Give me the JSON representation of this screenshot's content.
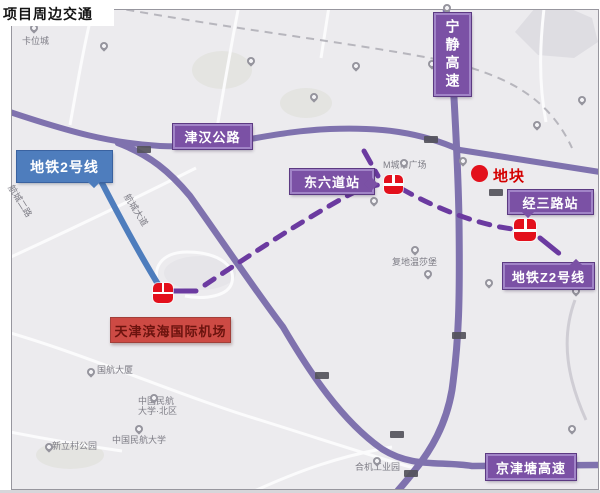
{
  "title": "项目周边交通",
  "colors": {
    "banner_purple": "#7b51a5",
    "banner_purple_light": "#a184c7",
    "banner_purple_dark": "#5c3a82",
    "road_purple": "#7f72ae",
    "dashed_metro_purple": "#6b3aa0",
    "metro_blue": "#4e7dbd",
    "red_banner": "#cd4a44",
    "red_banner_text": "#6b130e",
    "plot_red": "#e3101c",
    "map_background": "#ecebee"
  },
  "callouts": {
    "metro_line2": "地铁2号线",
    "jinhan_highway": "津汉公路",
    "ningjing_expressway": "宁静高速",
    "dongliudao_station": "东六道站",
    "jingsanlu_station": "经三路站",
    "metro_lineZ2": "地铁Z2号线",
    "jingjintang_expressway": "京津塘高速",
    "airport": "天津滨海国际机场",
    "plot": "地块"
  },
  "station_icons": [
    {
      "name": "dongliudao-station-icon",
      "x": 384,
      "y": 175,
      "s": 19
    },
    {
      "name": "jingsanlu-station-icon",
      "x": 514,
      "y": 219,
      "s": 22
    },
    {
      "name": "airport-station-icon",
      "x": 153,
      "y": 283,
      "s": 20
    }
  ],
  "basemap_labels": [
    {
      "text": "卡位城",
      "x": 22,
      "y": 36,
      "rot": 0
    },
    {
      "text": "M城市广场",
      "x": 383,
      "y": 160,
      "rot": 0
    },
    {
      "text": "复地温莎堡",
      "x": 392,
      "y": 257,
      "rot": 0
    },
    {
      "text": "航城大道",
      "x": 118,
      "y": 205,
      "rot": 58
    },
    {
      "text": "航城二路",
      "x": 2,
      "y": 196,
      "rot": 58
    },
    {
      "text": "国航大厦",
      "x": 97,
      "y": 365,
      "rot": 0
    },
    {
      "text": "中国民航\n大学·北区",
      "x": 138,
      "y": 396,
      "rot": 0
    },
    {
      "text": "中国民航大学",
      "x": 112,
      "y": 435,
      "rot": 0
    },
    {
      "text": "新立村公园",
      "x": 52,
      "y": 441,
      "rot": 0
    },
    {
      "text": "合机工业园",
      "x": 355,
      "y": 462,
      "rot": 0
    }
  ],
  "pins": [
    [
      30,
      24
    ],
    [
      100,
      42
    ],
    [
      247,
      57
    ],
    [
      352,
      62
    ],
    [
      428,
      60
    ],
    [
      310,
      93
    ],
    [
      443,
      4
    ],
    [
      578,
      96
    ],
    [
      459,
      157
    ],
    [
      533,
      121
    ],
    [
      400,
      159
    ],
    [
      370,
      197
    ],
    [
      411,
      246
    ],
    [
      424,
      270
    ],
    [
      485,
      279
    ],
    [
      572,
      287
    ],
    [
      87,
      368
    ],
    [
      150,
      394
    ],
    [
      135,
      425
    ],
    [
      45,
      443
    ],
    [
      373,
      457
    ],
    [
      568,
      425
    ]
  ],
  "road_shields": [
    [
      137,
      146
    ],
    [
      424,
      136
    ],
    [
      489,
      189
    ],
    [
      452,
      332
    ],
    [
      315,
      372
    ],
    [
      390,
      431
    ],
    [
      404,
      470
    ]
  ]
}
